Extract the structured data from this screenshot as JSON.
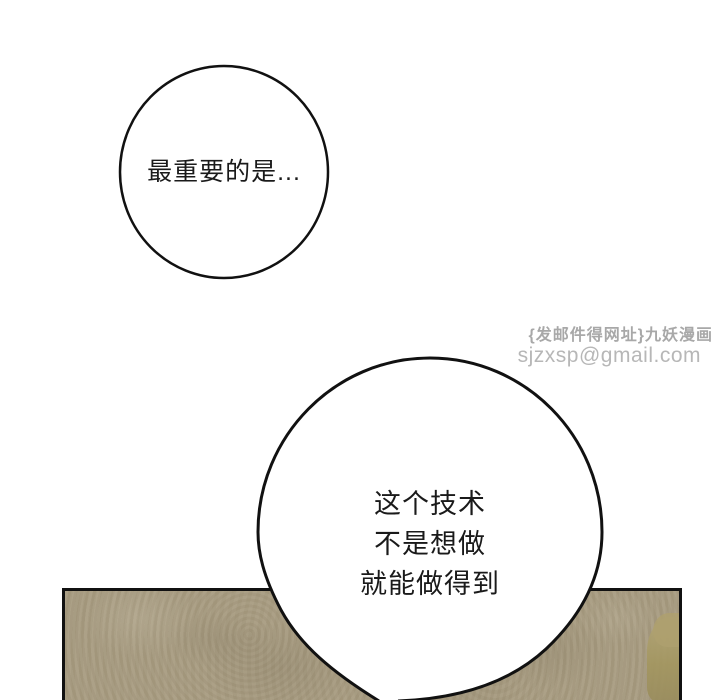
{
  "page": {
    "background_color": "#ffffff",
    "width": 720,
    "height": 700
  },
  "watermark": {
    "site_label": "{发邮件得网址}九妖漫画",
    "email": "sjzxsp@gmail.com",
    "site_color": "#a8a8a8",
    "email_color": "#b7b7b7"
  },
  "bubbles": {
    "small": {
      "text": "最重要的是..."
    },
    "large": {
      "lines": [
        "这个技术",
        "不是想做",
        "就能做得到"
      ]
    },
    "stroke_color": "#111111",
    "fill_color": "#ffffff",
    "text_color": "#1a1a1a"
  },
  "panel": {
    "fill_color": "#a89c81",
    "border_color": "#111111",
    "blob_color": "#a3965f"
  }
}
